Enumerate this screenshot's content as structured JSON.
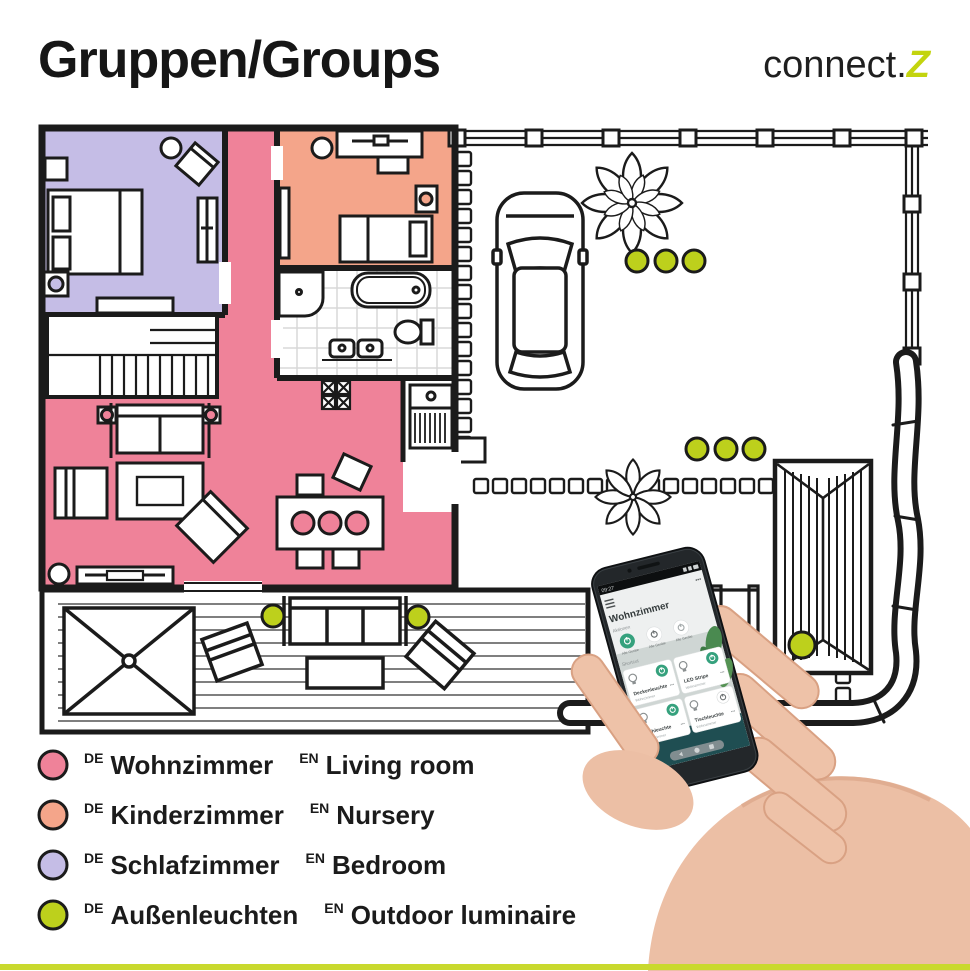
{
  "header": {
    "title": "Gruppen/Groups",
    "logo_text": "connect.",
    "logo_z": "Z"
  },
  "colors": {
    "living": "#ef8299",
    "nursery": "#f4a58a",
    "bedroom": "#c5bde6",
    "outdoor": "#bdd01c",
    "accent_green": "#35a17d",
    "logo_green": "#c3d40e",
    "bottom_bar": "#c9d92e",
    "wall": "#1b1b1b"
  },
  "legend": {
    "items": [
      {
        "color": "#ef8299",
        "lang1": "DE",
        "name1": "Wohnzimmer",
        "lang2": "EN",
        "name2": "Living room"
      },
      {
        "color": "#f4a58a",
        "lang1": "DE",
        "name1": "Kinderzimmer",
        "lang2": "EN",
        "name2": "Nursery"
      },
      {
        "color": "#c5bde6",
        "lang1": "DE",
        "name1": "Schlafzimmer",
        "lang2": "EN",
        "name2": "Bedroom"
      },
      {
        "color": "#bdd01c",
        "lang1": "DE",
        "name1": "Außenleuchten",
        "lang2": "EN",
        "name2": "Outdoor luminaire"
      }
    ]
  },
  "phone": {
    "status_time": "09:27",
    "more_icon": "•••",
    "title": "Wohnzimmer",
    "section_actions": "Aktionen",
    "all_devices": [
      "Alle Geräte",
      "Alle Geräte",
      "Alle Geräte"
    ],
    "section_shortcut": "Shortcut",
    "cards": [
      {
        "name": "Deckenleuchte",
        "room": "Wohnzimmer",
        "more": "•••"
      },
      {
        "name": "LED Stripe",
        "room": "Wohnzimmer",
        "more": "•••"
      },
      {
        "name": "Stehleuchte",
        "room": "Wohnzimmer",
        "more": "•••"
      },
      {
        "name": "Tischleuchte",
        "room": "Wohnzimmer",
        "more": "•••"
      }
    ]
  }
}
